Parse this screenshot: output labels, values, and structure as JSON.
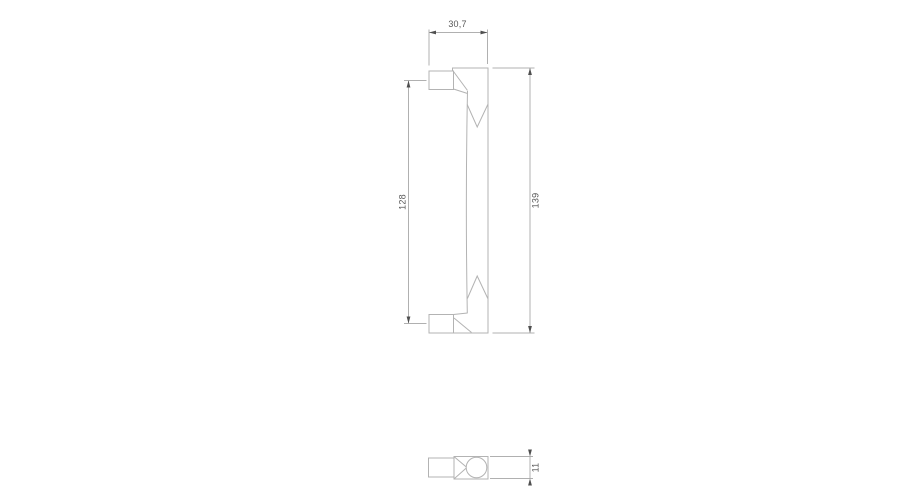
{
  "colors": {
    "background": "#ffffff",
    "line": "#b3b3b3",
    "dimension": "#b0b0b0",
    "arrow": "#4f4f4f",
    "text": "#565656"
  },
  "dimensions": {
    "top_width": {
      "label": "30,7"
    },
    "hole_spacing": {
      "label": "128"
    },
    "overall_length": {
      "label": "139"
    },
    "thickness": {
      "label": "11"
    }
  }
}
